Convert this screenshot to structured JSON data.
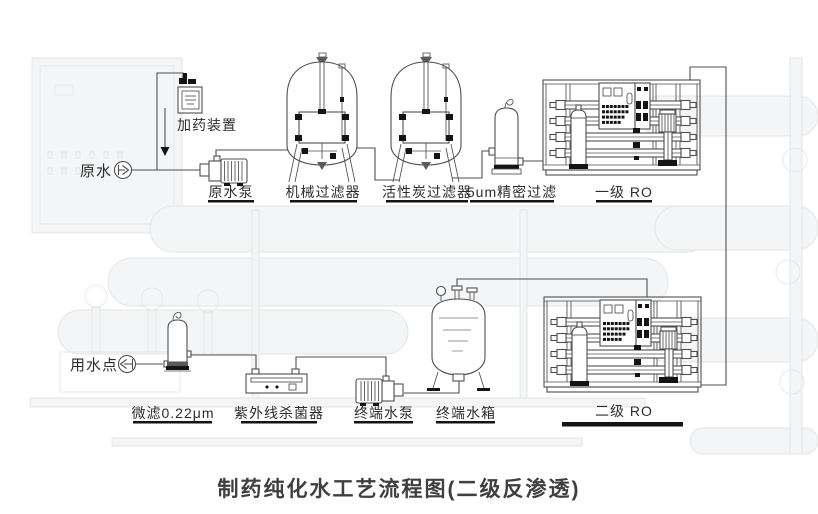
{
  "title": "制药纯化水工艺流程图(二级反渗透)",
  "labels": {
    "raw_water": "原水",
    "dosing_device": "加药装置",
    "raw_water_pump": "原水泵",
    "mechanical_filter": "机械过滤器",
    "carbon_filter": "活性炭过滤器",
    "precision_filter": "5um精密过滤",
    "first_stage_ro": "一级 RO",
    "microfilter": "微滤0.22μm",
    "uv_sterilizer": "紫外线杀菌器",
    "terminal_pump": "终端水泵",
    "terminal_tank": "终端水箱",
    "second_stage_ro": "二级 RO",
    "water_use_point": "用水点"
  },
  "colors": {
    "line": "#4f4f4f",
    "text": "#2d2d2d",
    "underline": "#141414",
    "title": "#3f3f3f"
  }
}
